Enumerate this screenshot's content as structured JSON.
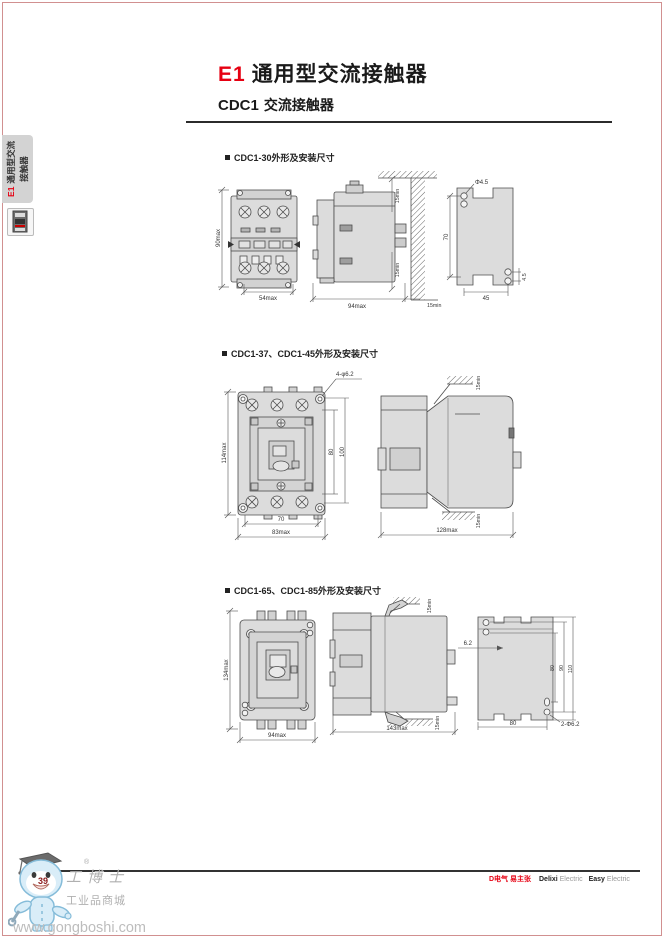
{
  "page": {
    "title": {
      "code": "E1",
      "text": "通用型交流接触器"
    },
    "subtitle": {
      "model": "CDC1",
      "text": "交流接触器"
    },
    "page_number": "39",
    "frame_color": "#d19090"
  },
  "sidebar": {
    "tab": {
      "code": "E1",
      "series": "通用型交流",
      "series2": "接触器"
    },
    "icon": "contactor-product-icon"
  },
  "sections": [
    {
      "heading": "CDC1-30外形及安装尺寸",
      "front_height": "90max",
      "front_width": "54max",
      "side_top": "15min",
      "side_bottom": "15min",
      "side_width": "94max",
      "side_right": "15min",
      "plate_hole": "Φ4.5",
      "plate_height": "70",
      "plate_width": "45",
      "plate_offset": "4.5"
    },
    {
      "heading": "CDC1-37、CDC1-45外形及安装尺寸",
      "holes": "4-φ6.2",
      "height": "114max",
      "h80": "80",
      "h100": "100",
      "w70": "70",
      "width": "83max",
      "side_top": "15min",
      "side_bottom": "15min",
      "depth": "128max"
    },
    {
      "heading": "CDC1-65、CDC1-85外形及安装尺寸",
      "height": "134max",
      "width": "94max",
      "side_top": "15min",
      "side_bottom": "15min",
      "depth": "143max",
      "offset": "6.2",
      "v80": "80",
      "v90": "90",
      "v110": "110",
      "pwidth": "80",
      "holes": "2-Φ6.2"
    }
  ],
  "footer": {
    "slogan": "D电气 易主张",
    "brand_bold_1": "Delixi",
    "brand_light_1": "Electric",
    "brand_bold_2": "Easy",
    "brand_light_2": "Electric"
  },
  "watermark": {
    "name": "工博士",
    "reg": "®",
    "tagline": "工业品商城",
    "url": "www.gongboshi.com"
  }
}
